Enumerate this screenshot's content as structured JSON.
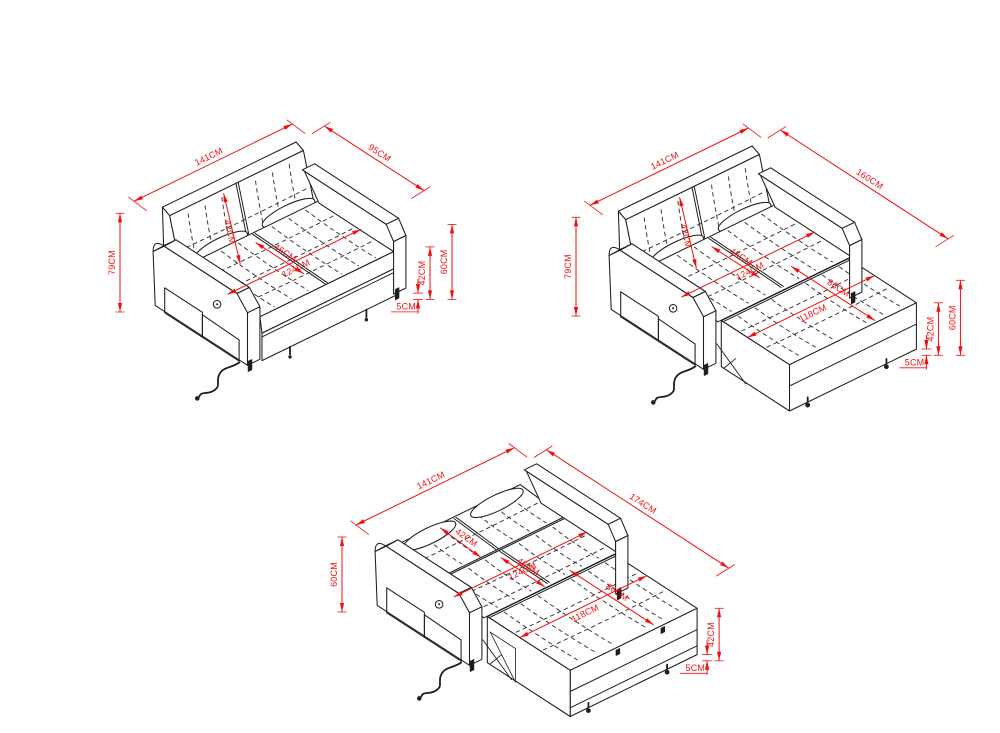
{
  "canvas": {
    "width": 1000,
    "height": 733,
    "background": "#ffffff"
  },
  "style": {
    "dimension_color": "#f2100e",
    "line_color": "#1e1e1e",
    "stitch_color": "#333333"
  },
  "unit": "CM",
  "views": [
    {
      "id": "sofa-closed",
      "dims": {
        "top_left": "141CM",
        "top_right": "95CM",
        "left_vertical": "79CM",
        "backrest_diag": "42CM",
        "seat_depth_diag": "46CM",
        "seat_width_diag": "124CM",
        "right_vertical_inner": "42CM",
        "right_vertical_outer": "60CM",
        "clearance": "5CM"
      }
    },
    {
      "id": "sofa-half-extended",
      "dims": {
        "top_left": "141CM",
        "top_right": "160CM",
        "left_vertical": "79CM",
        "backrest_diag": "42CM",
        "seat_depth_diag": "46CM",
        "seat_width_diag": "124CM",
        "bed_depth_diag": "86CM",
        "bed_width_diag": "118CM",
        "right_vertical_inner": "42CM",
        "right_vertical_outer": "60CM",
        "clearance": "5CM"
      }
    },
    {
      "id": "sofa-bed-extended",
      "dims": {
        "top_left": "141CM",
        "top_right": "174CM",
        "left_vertical": "60CM",
        "backrest_diag": "42CM",
        "seat_depth_diag": "46CM",
        "seat_width_diag": "124CM",
        "bed_depth_diag": "86CM",
        "bed_width_diag": "118CM",
        "right_vertical_inner": "42CM",
        "clearance": "5CM"
      }
    }
  ]
}
